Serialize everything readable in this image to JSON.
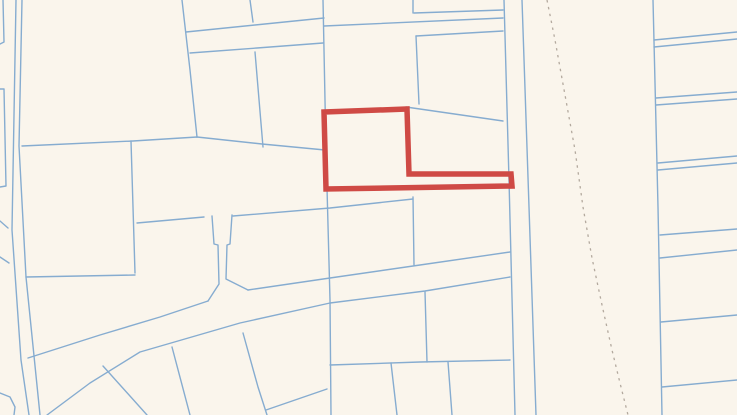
{
  "map": {
    "width": 737,
    "height": 415,
    "background_color": "#faf5ec",
    "parcel_line_color": "#86acd0",
    "parcel_line_width": 1.4,
    "dashed_line_color": "#b3a99e",
    "dashed_line_width": 1.3,
    "dashed_pattern": "2.5 4.5",
    "highlight_color": "#cf4a45",
    "highlight_width": 5.5,
    "highlighted_parcel": {
      "name": "highlighted-parcel",
      "points": [
        [
          324,
          112
        ],
        [
          407,
          109
        ],
        [
          409,
          174
        ],
        [
          511,
          174
        ],
        [
          512,
          186
        ],
        [
          326,
          189
        ]
      ]
    },
    "dashed_line": {
      "name": "survey-dashed-line",
      "points": [
        [
          547,
          0
        ],
        [
          555,
          40
        ],
        [
          565,
          95
        ],
        [
          575,
          150
        ],
        [
          583,
          207
        ],
        [
          592,
          258
        ],
        [
          602,
          305
        ],
        [
          612,
          350
        ],
        [
          620,
          383
        ],
        [
          628,
          415
        ]
      ]
    },
    "parcel_lines": [
      {
        "name": "road-west-left",
        "points": [
          [
            16,
            0
          ],
          [
            12,
            230
          ],
          [
            21,
            360
          ],
          [
            29,
            415
          ]
        ]
      },
      {
        "name": "road-west-right",
        "points": [
          [
            22,
            0
          ],
          [
            19,
            146
          ],
          [
            26,
            277
          ],
          [
            40,
            415
          ]
        ]
      },
      {
        "name": "edge-parcel-nw",
        "points": [
          [
            3,
            0
          ],
          [
            4,
            42
          ],
          [
            0,
            44
          ]
        ]
      },
      {
        "name": "edge-parcel-w",
        "points": [
          [
            0,
            89
          ],
          [
            4,
            89
          ],
          [
            6,
            186
          ],
          [
            0,
            187
          ]
        ]
      },
      {
        "name": "edge-tick-w1",
        "points": [
          [
            0,
            221
          ],
          [
            8,
            228
          ]
        ]
      },
      {
        "name": "edge-tick-w2",
        "points": [
          [
            0,
            257
          ],
          [
            9,
            263
          ]
        ]
      },
      {
        "name": "edge-corner-sw",
        "points": [
          [
            0,
            393
          ],
          [
            10,
            397
          ],
          [
            15,
            407
          ],
          [
            14,
            415
          ]
        ]
      },
      {
        "name": "horiz-main-left",
        "points": [
          [
            22,
            146
          ],
          [
            133,
            141
          ],
          [
            197,
            137
          ],
          [
            262,
            144
          ],
          [
            325,
            150
          ]
        ]
      },
      {
        "name": "slant-vert-nw",
        "points": [
          [
            182,
            0
          ],
          [
            190,
            70
          ],
          [
            197,
            137
          ]
        ]
      },
      {
        "name": "divider-mid",
        "points": [
          [
            255,
            52
          ],
          [
            263,
            147
          ]
        ]
      },
      {
        "name": "lane-top",
        "points": [
          [
            186,
            32
          ],
          [
            255,
            25
          ],
          [
            324,
            18
          ]
        ]
      },
      {
        "name": "lane-bottom",
        "points": [
          [
            190,
            53
          ],
          [
            257,
            48
          ],
          [
            323,
            43
          ]
        ]
      },
      {
        "name": "vert-top-a",
        "points": [
          [
            250,
            0
          ],
          [
            253,
            22
          ]
        ]
      },
      {
        "name": "vert-main-center",
        "points": [
          [
            323,
            0
          ],
          [
            326,
            150
          ],
          [
            330,
            300
          ],
          [
            331,
            415
          ]
        ]
      },
      {
        "name": "vert-top-b",
        "points": [
          [
            413,
            0
          ],
          [
            413,
            13
          ]
        ]
      },
      {
        "name": "horiz-ne-1",
        "points": [
          [
            414,
            13
          ],
          [
            503,
            10
          ]
        ]
      },
      {
        "name": "horiz-ne-long",
        "points": [
          [
            324,
            26
          ],
          [
            503,
            18
          ]
        ]
      },
      {
        "name": "horiz-ne-2",
        "points": [
          [
            416,
            36
          ],
          [
            503,
            31
          ]
        ]
      },
      {
        "name": "vert-ne",
        "points": [
          [
            416,
            36
          ],
          [
            419,
            104
          ]
        ]
      },
      {
        "name": "diag-ne",
        "points": [
          [
            406,
            107
          ],
          [
            503,
            121
          ]
        ]
      },
      {
        "name": "horiz-below-strip",
        "points": [
          [
            233,
            216
          ],
          [
            330,
            208
          ],
          [
            413,
            199
          ]
        ]
      },
      {
        "name": "vert-mid-413",
        "points": [
          [
            413,
            197
          ],
          [
            414,
            265
          ]
        ]
      },
      {
        "name": "horiz-t-left",
        "points": [
          [
            137,
            223
          ],
          [
            204,
            217
          ]
        ]
      },
      {
        "name": "t-neck-left",
        "points": [
          [
            212,
            216
          ],
          [
            214,
            244
          ],
          [
            218,
            245
          ],
          [
            219,
            284
          ],
          [
            208,
            301
          ]
        ]
      },
      {
        "name": "t-neck-right",
        "points": [
          [
            232,
            215
          ],
          [
            230,
            244
          ],
          [
            227,
            245
          ],
          [
            226,
            279
          ],
          [
            248,
            290
          ]
        ]
      },
      {
        "name": "vert-133",
        "points": [
          [
            131,
            141
          ],
          [
            135,
            273
          ]
        ]
      },
      {
        "name": "horiz-277",
        "points": [
          [
            26,
            277
          ],
          [
            135,
            275
          ]
        ]
      },
      {
        "name": "road-diag-upper-w",
        "points": [
          [
            28,
            358
          ],
          [
            100,
            335
          ],
          [
            160,
            317
          ],
          [
            208,
            301
          ]
        ]
      },
      {
        "name": "road-diag-upper-e",
        "points": [
          [
            248,
            290
          ],
          [
            330,
            278
          ],
          [
            420,
            265
          ],
          [
            510,
            252
          ]
        ]
      },
      {
        "name": "road-diag-lower",
        "points": [
          [
            47,
            415
          ],
          [
            90,
            383
          ],
          [
            140,
            352
          ],
          [
            240,
            323
          ],
          [
            330,
            303
          ],
          [
            425,
            291
          ],
          [
            510,
            277
          ]
        ]
      },
      {
        "name": "below-road-1",
        "points": [
          [
            103,
            366
          ],
          [
            147,
            415
          ]
        ]
      },
      {
        "name": "below-road-2",
        "points": [
          [
            172,
            347
          ],
          [
            190,
            415
          ]
        ]
      },
      {
        "name": "below-road-3",
        "points": [
          [
            243,
            333
          ],
          [
            258,
            387
          ],
          [
            267,
            415
          ]
        ]
      },
      {
        "name": "below-road-4",
        "points": [
          [
            266,
            410
          ],
          [
            327,
            389
          ]
        ]
      },
      {
        "name": "horiz-363",
        "points": [
          [
            330,
            365
          ],
          [
            420,
            362
          ],
          [
            510,
            360
          ]
        ]
      },
      {
        "name": "vert-425",
        "points": [
          [
            425,
            292
          ],
          [
            427,
            362
          ]
        ]
      },
      {
        "name": "vert-391",
        "points": [
          [
            391,
            363
          ],
          [
            397,
            415
          ]
        ]
      },
      {
        "name": "vert-449",
        "points": [
          [
            448,
            362
          ],
          [
            452,
            415
          ]
        ]
      },
      {
        "name": "corridor-left",
        "points": [
          [
            504,
            0
          ],
          [
            509,
            180
          ],
          [
            515,
            415
          ]
        ]
      },
      {
        "name": "corridor-right",
        "points": [
          [
            522,
            0
          ],
          [
            529,
            207
          ],
          [
            536,
            415
          ]
        ]
      },
      {
        "name": "vert-east",
        "points": [
          [
            653,
            0
          ],
          [
            658,
            207
          ],
          [
            662,
            415
          ]
        ]
      },
      {
        "name": "east-strip-1a",
        "points": [
          [
            654,
            40
          ],
          [
            737,
            32
          ]
        ]
      },
      {
        "name": "east-strip-1b",
        "points": [
          [
            654,
            47
          ],
          [
            737,
            39
          ]
        ]
      },
      {
        "name": "east-strip-2a",
        "points": [
          [
            656,
            98
          ],
          [
            737,
            92
          ]
        ]
      },
      {
        "name": "east-strip-2b",
        "points": [
          [
            656,
            105
          ],
          [
            737,
            99
          ]
        ]
      },
      {
        "name": "east-strip-3a",
        "points": [
          [
            658,
            163
          ],
          [
            737,
            156
          ]
        ]
      },
      {
        "name": "east-strip-3b",
        "points": [
          [
            658,
            170
          ],
          [
            737,
            163
          ]
        ]
      },
      {
        "name": "east-strip-4",
        "points": [
          [
            660,
            235
          ],
          [
            737,
            229
          ]
        ]
      },
      {
        "name": "east-strip-5",
        "points": [
          [
            660,
            258
          ],
          [
            737,
            250
          ]
        ]
      },
      {
        "name": "east-strip-6",
        "points": [
          [
            661,
            322
          ],
          [
            737,
            315
          ]
        ]
      },
      {
        "name": "east-strip-7",
        "points": [
          [
            662,
            387
          ],
          [
            737,
            380
          ]
        ]
      }
    ]
  }
}
